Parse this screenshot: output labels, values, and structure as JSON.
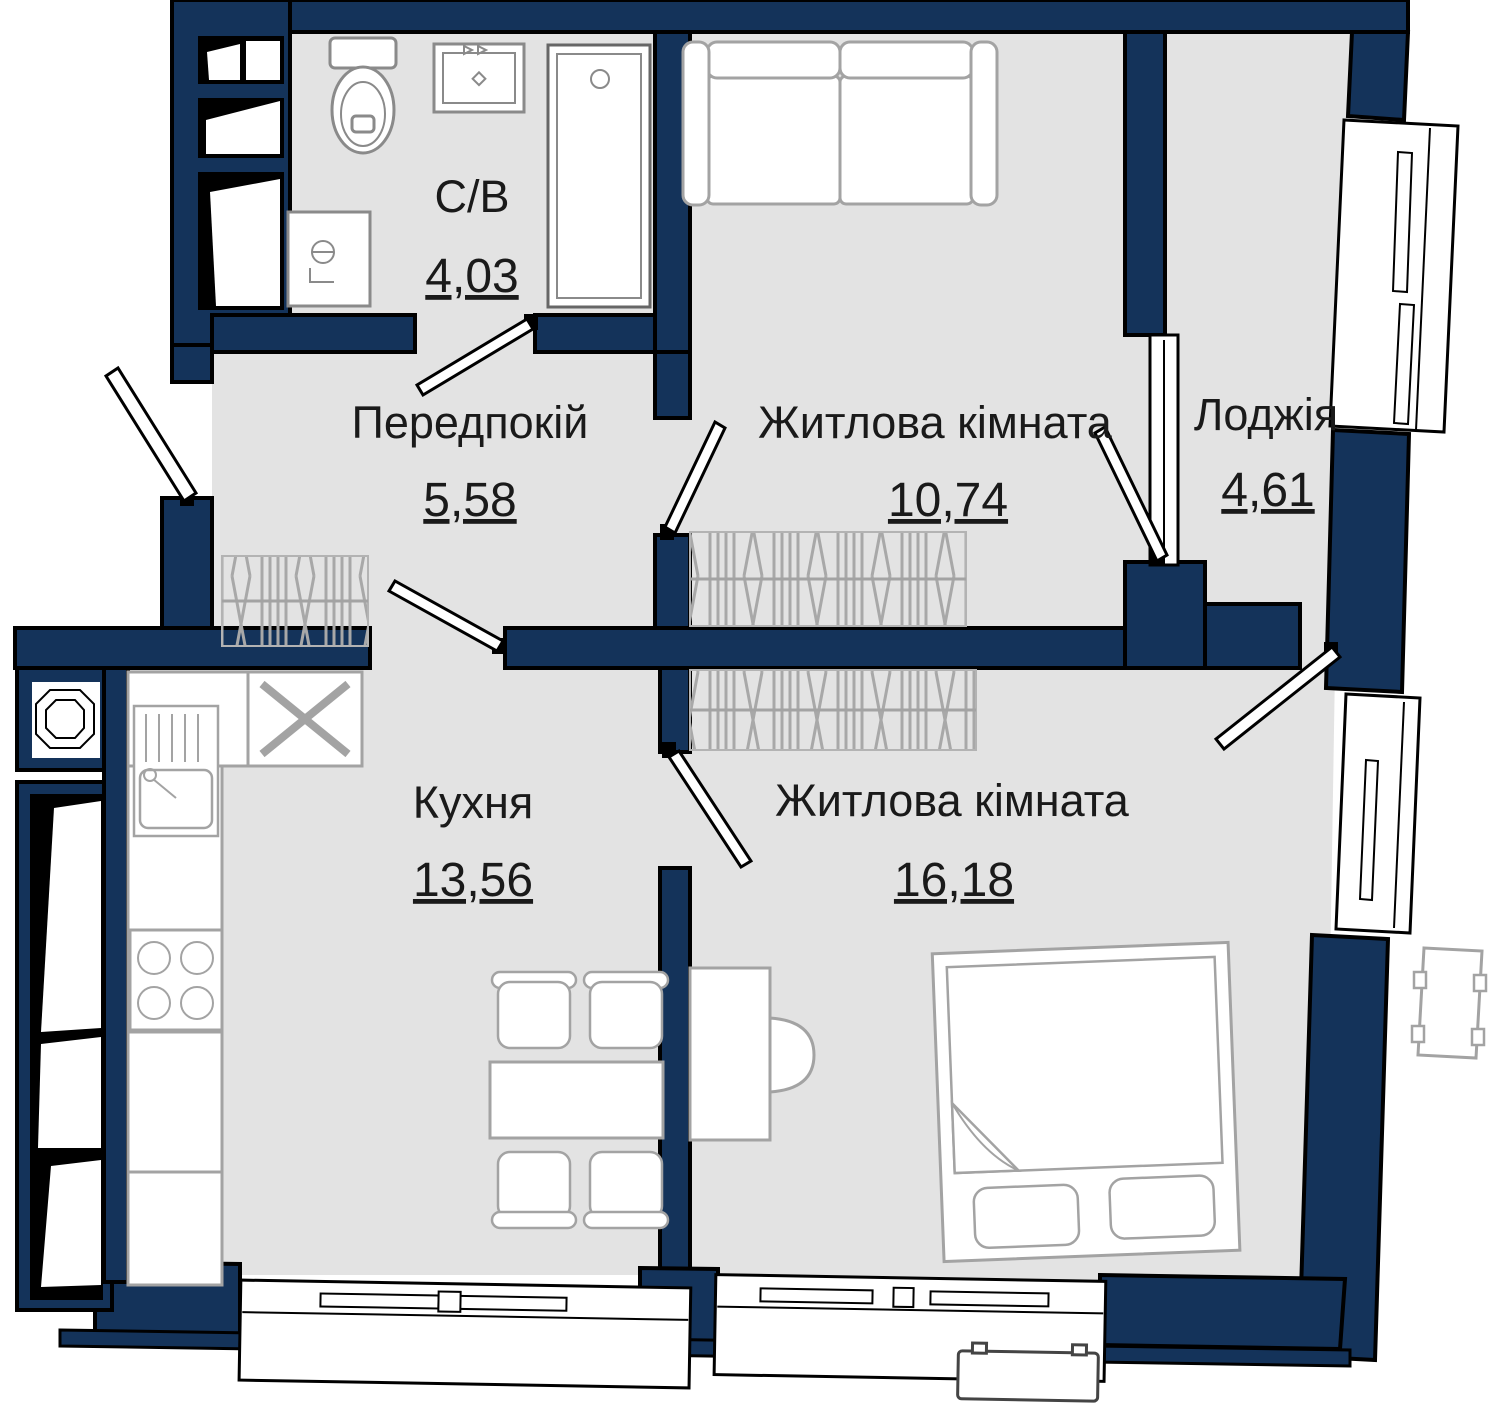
{
  "colors": {
    "wall": "#14335a",
    "outline": "#000000",
    "floor": "#e3e3e3",
    "furniture_line": "#a3a3a3",
    "fixture_line": "#8a8a8a",
    "text": "#1a1a1a"
  },
  "rooms": {
    "bathroom": {
      "name": "С/В",
      "area": "4,03"
    },
    "hallway": {
      "name": "Передпокій",
      "area": "5,58"
    },
    "living_room_1": {
      "name": "Житлова кімната",
      "area": "10,74"
    },
    "loggia": {
      "name": "Лоджія",
      "area": "4,61"
    },
    "kitchen": {
      "name": "Кухня",
      "area": "13,56"
    },
    "living_room_2": {
      "name": "Житлова кімната",
      "area": "16,18"
    }
  },
  "icons": [
    "toilet-icon",
    "bathroom-sink-icon",
    "shower-icon",
    "washing-machine-icon",
    "kitchen-sink-icon",
    "stove-icon",
    "fridge-slot-icon",
    "dining-table-icon",
    "chair-icon",
    "sofa-icon",
    "wardrobe-icon",
    "desk-icon",
    "desk-chair-icon",
    "bed-icon",
    "door-leaf-icon",
    "window-icon",
    "vent-shaft-icon",
    "ac-unit-icon"
  ]
}
